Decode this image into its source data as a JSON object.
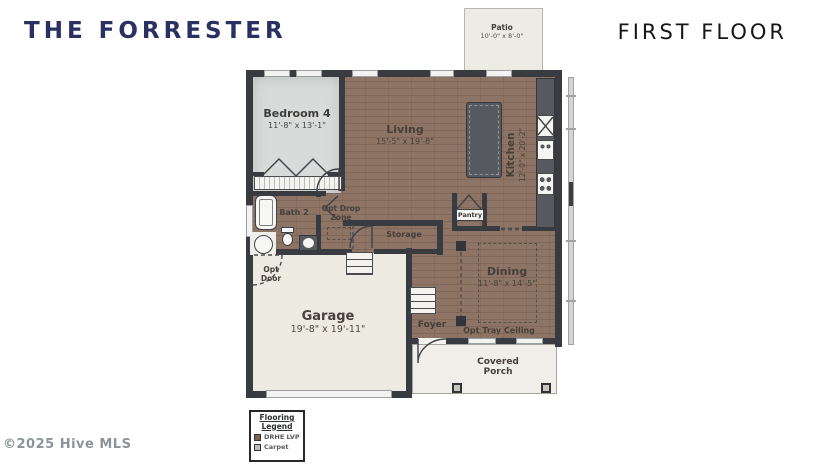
{
  "header": {
    "plan_name": "THE FORRESTER",
    "floor_label": "FIRST FLOOR"
  },
  "watermark": "©2025 Hive MLS",
  "colors": {
    "title_navy": "#2a3162",
    "wall": "#383b40",
    "floor_lvp": "#8d7464",
    "carpet": "#d9dbda",
    "cream": "#eceae1",
    "counter": "#565a5f"
  },
  "rooms": {
    "patio": {
      "name": "Patio",
      "dims": "10'-0\" x 8'-0\""
    },
    "bedroom4": {
      "name": "Bedroom 4",
      "dims": "11'-8\" x 13'-1\""
    },
    "living": {
      "name": "Living",
      "dims": "15'-5\" x 19'-8\""
    },
    "kitchen": {
      "name": "Kitchen",
      "dims": "12'-0\" x 20'-2\""
    },
    "bath2": {
      "name": "Bath 2"
    },
    "opt_drop_zone": {
      "name": "Opt Drop Zone"
    },
    "storage": {
      "name": "Storage"
    },
    "pantry": {
      "name": "Pantry"
    },
    "dining": {
      "name": "Dining",
      "dims": "11'-8\" x 14'-5\""
    },
    "opt_tray_ceiling": {
      "name": "Opt Tray Ceiling"
    },
    "garage": {
      "name": "Garage",
      "dims": "19'-8\" x 19'-11\""
    },
    "foyer": {
      "name": "Foyer"
    },
    "opt_door": {
      "name": "Opt Door"
    },
    "covered_porch": {
      "name": "Covered Porch"
    }
  },
  "legend": {
    "title": "Flooring Legend",
    "items": [
      {
        "label": "DRHE LVP",
        "color": "#7d5f4c"
      },
      {
        "label": "Carpet",
        "color": "#b9bcbc"
      }
    ]
  }
}
